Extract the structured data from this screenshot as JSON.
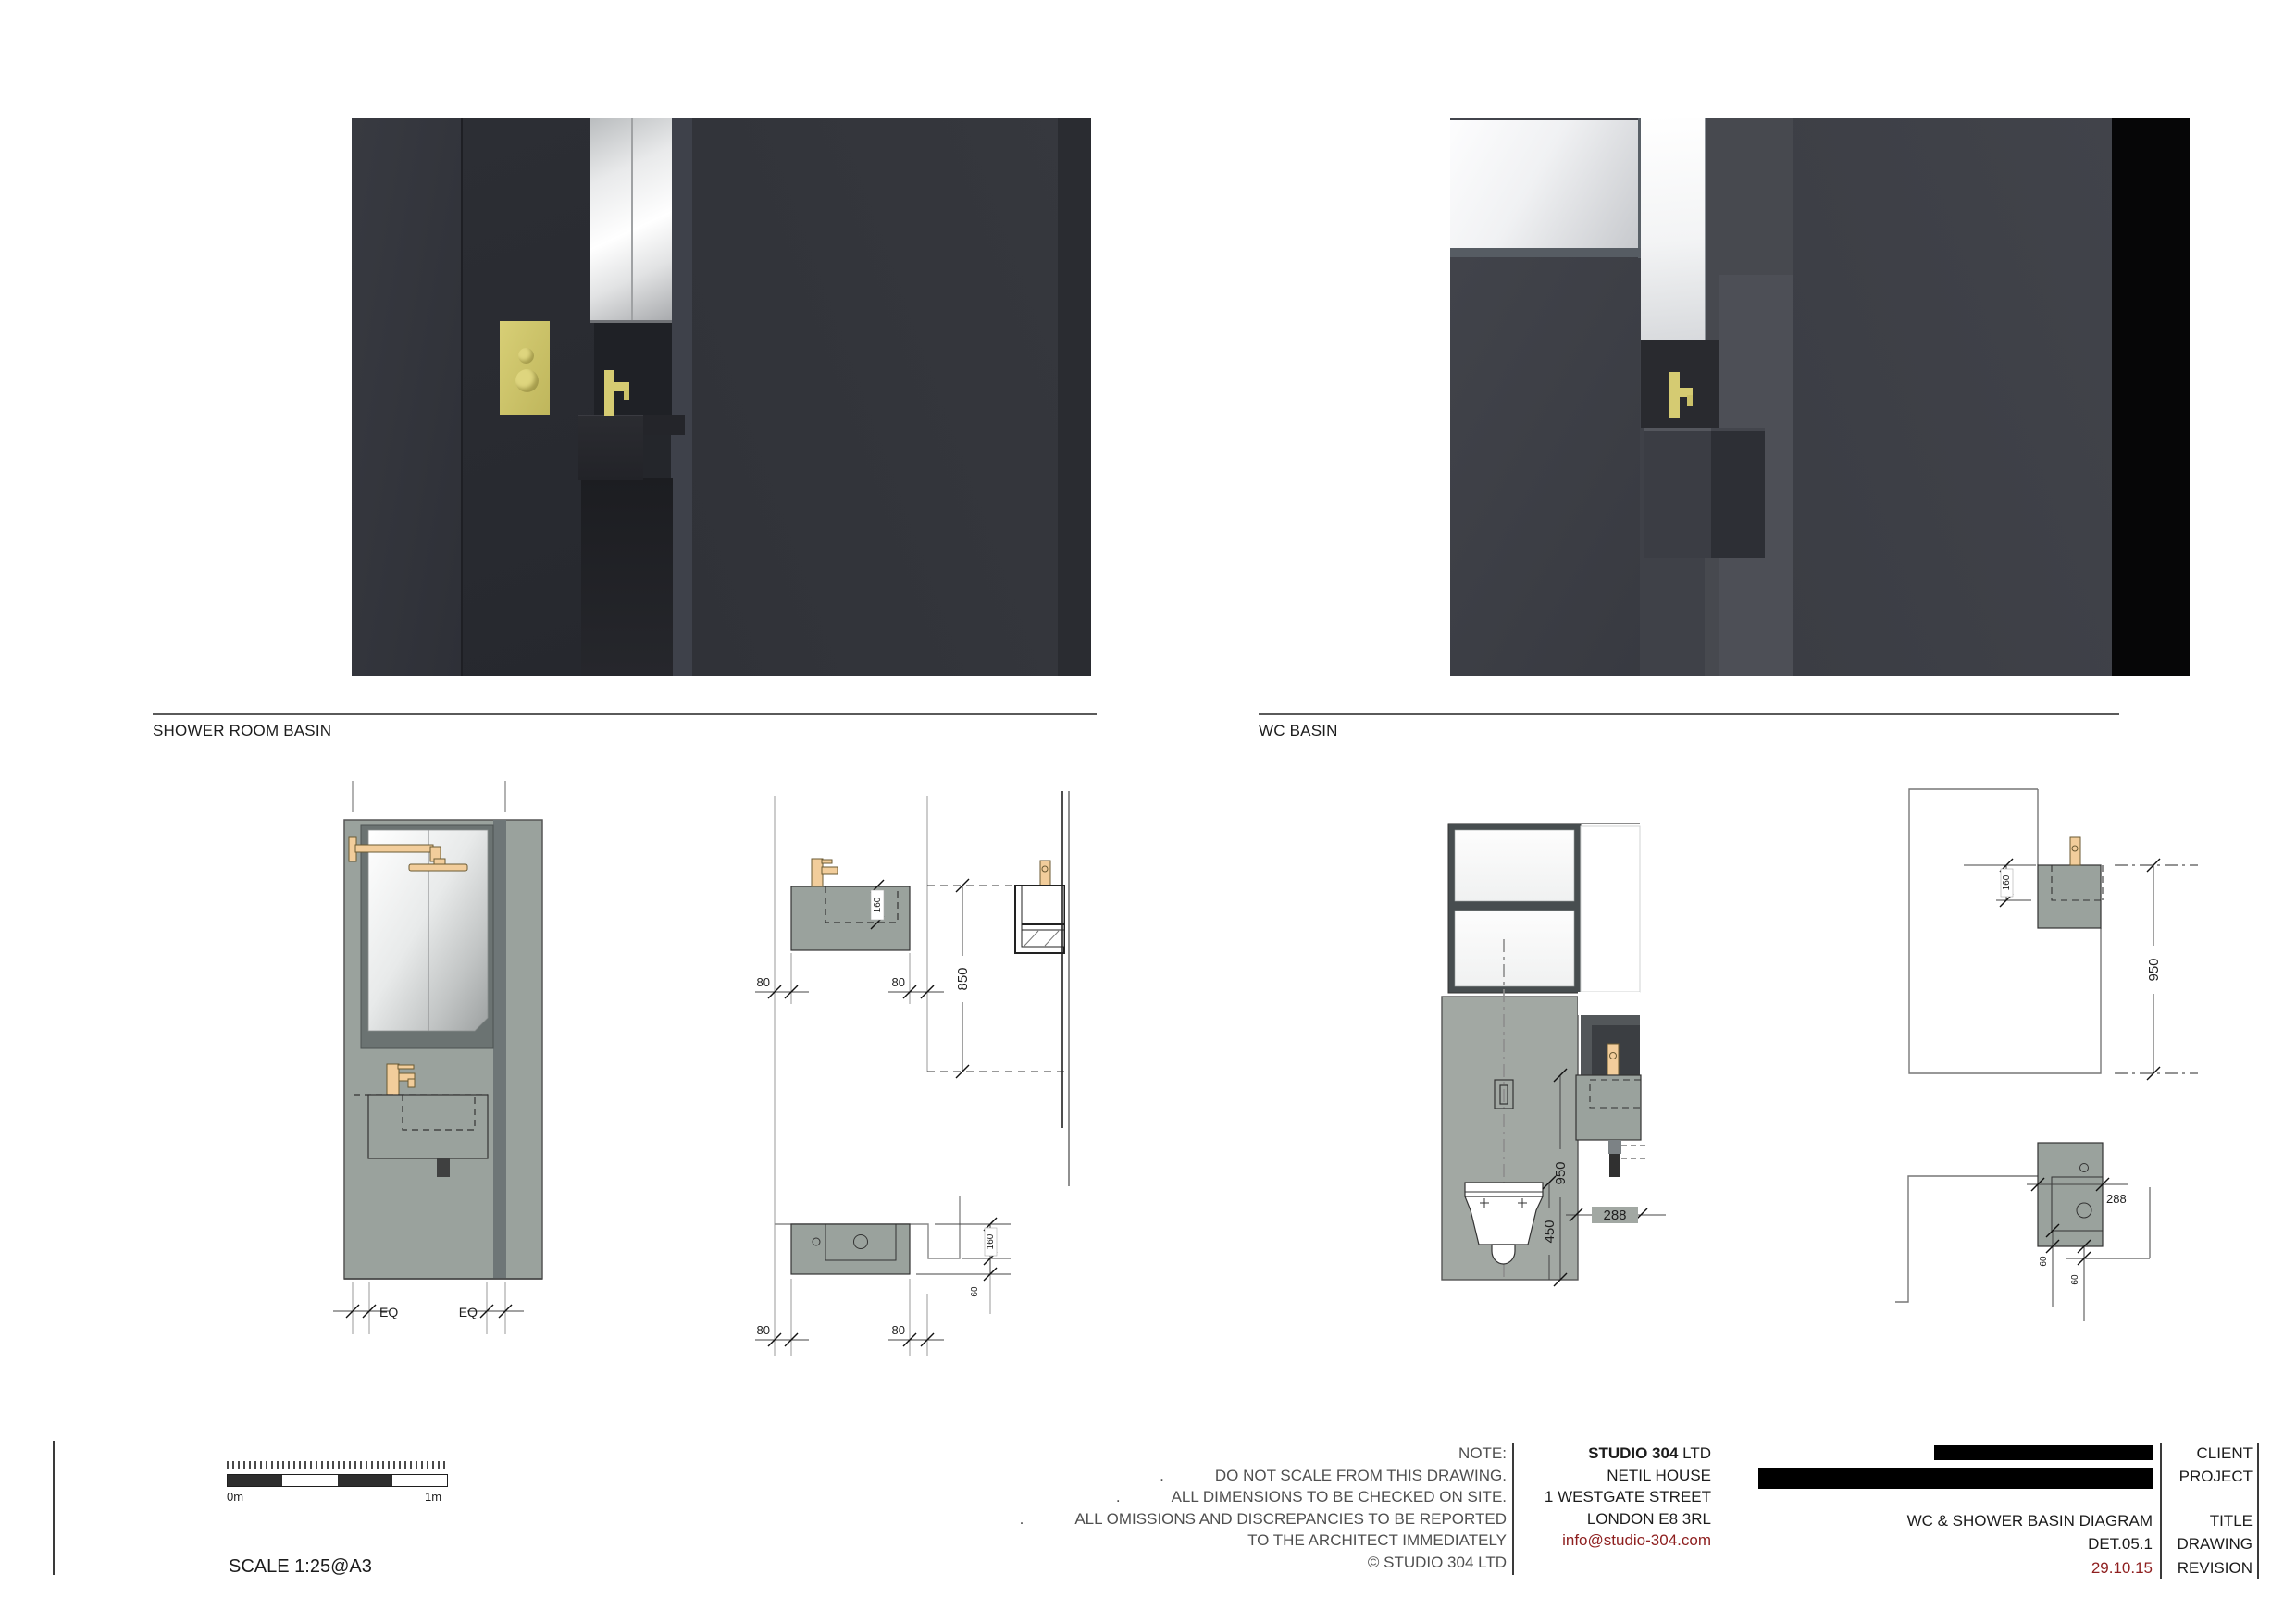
{
  "sections": {
    "shower_label": "SHOWER ROOM BASIN",
    "wc_label": "WC BASIN"
  },
  "dims": {
    "sf_bowl": "160",
    "sf_left": "80",
    "sf_right": "80",
    "sf_height": "850",
    "sp_left": "80",
    "sp_right": "80",
    "sp_depth": "160",
    "sp_edge": "60",
    "se_eq_left": "EQ",
    "se_eq_right": "EQ",
    "we_height": "950",
    "we_wc": "450",
    "we_width": "288",
    "ws_bowl": "160",
    "ws_height": "950",
    "wp_width": "288",
    "wp_d1": "60",
    "wp_d2": "60"
  },
  "notes": {
    "heading": "NOTE:",
    "bullet": ".",
    "lines": [
      "DO NOT SCALE FROM THIS DRAWING.",
      "ALL DIMENSIONS TO BE CHECKED ON SITE.",
      "ALL OMISSIONS AND DISCREPANCIES TO BE REPORTED",
      "TO THE ARCHITECT IMMEDIATELY",
      "© STUDIO 304 LTD"
    ]
  },
  "studio": {
    "name_bold": "STUDIO 304",
    "name_suffix": " LTD",
    "address1": "NETIL HOUSE",
    "address2": "1 WESTGATE STREET",
    "address3": "LONDON E8 3RL",
    "email": "info@studio-304.com"
  },
  "titleblock": {
    "labels": {
      "client": "CLIENT",
      "project": "PROJECT",
      "title": "TITLE",
      "drawing": "DRAWING",
      "revision": "REVISION"
    },
    "title": "WC & SHOWER BASIN DIAGRAM",
    "drawing_no": "DET.05.1",
    "revision_date": "29.10.15"
  },
  "scale": {
    "label": "SCALE 1:25@A3",
    "start": "0m",
    "end": "1m"
  },
  "colors": {
    "brass_render": "#d5cb72",
    "brass_drawing": "#f2cd9b",
    "panel_grey": "#9aa29d",
    "wall_grey": "#a2a8a3",
    "accent_red": "#8e1f1f",
    "redaction": "#000000",
    "line": "#333333"
  }
}
